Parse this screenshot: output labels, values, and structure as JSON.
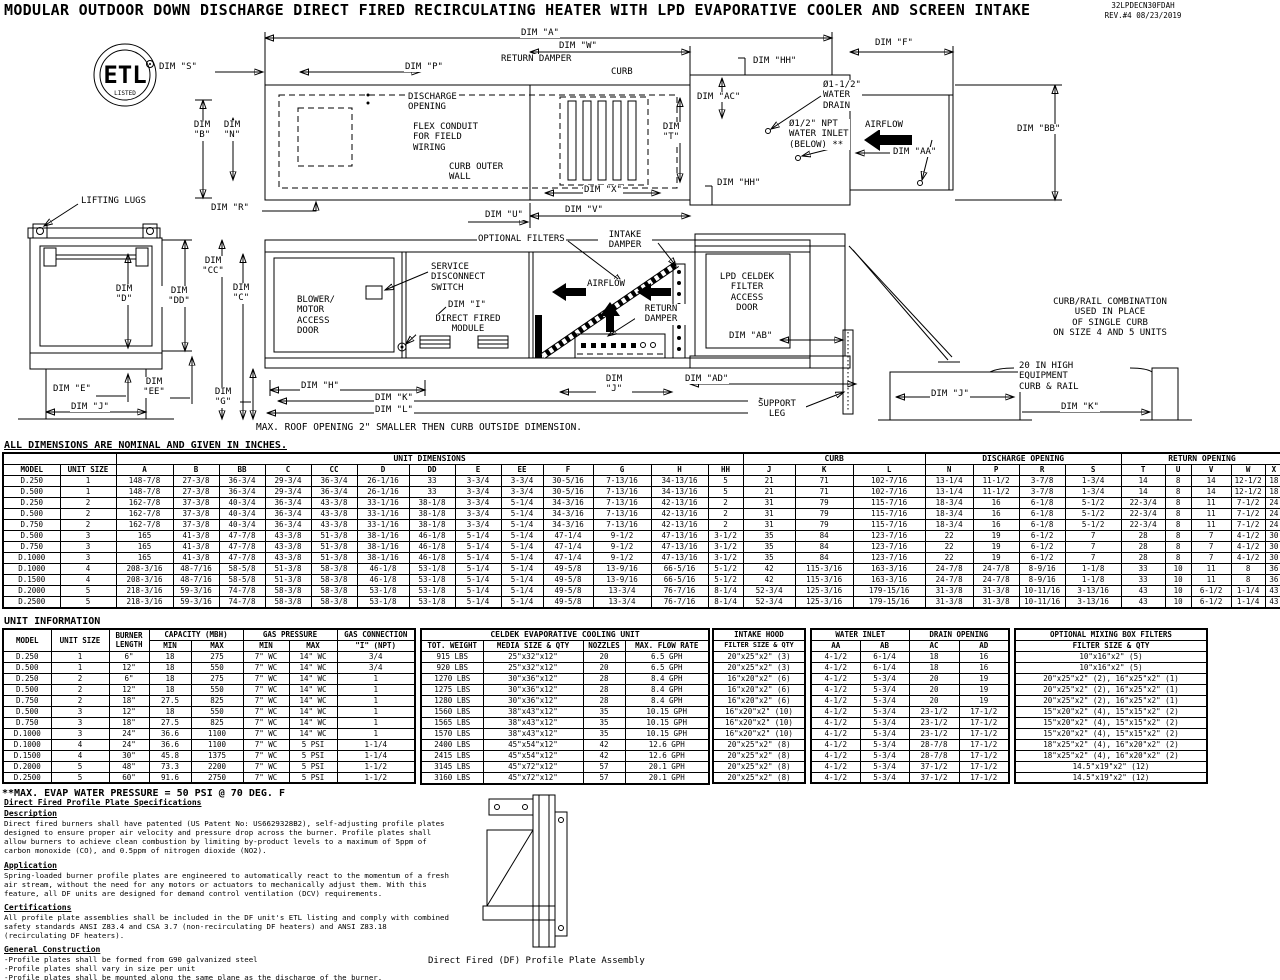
{
  "header": {
    "title": "MODULAR OUTDOOR DOWN DISCHARGE DIRECT FIRED RECIRCULATING HEATER WITH LPD EVAPORATIVE COOLER AND SCREEN INTAKE",
    "doc_number": "32LPDECN30FDAH",
    "rev": "REV.#4   08/23/2019"
  },
  "drawing": {
    "labels": {
      "etl_mark": "ETL",
      "etl_listed": "LISTED",
      "dim_a": "DIM \"A\"",
      "dim_w": "DIM \"W\"",
      "dim_f": "DIM \"F\"",
      "dim_hh_top": "DIM \"HH\"",
      "dim_hh_bottom": "DIM \"HH\"",
      "dim_s": "DIM \"S\"",
      "dim_p": "DIM \"P\"",
      "return_damper_plan": "RETURN DAMPER",
      "curb": "CURB",
      "dim_b": "DIM\n\"B\"",
      "dim_n": "DIM\n\"N\"",
      "dim_r": "DIM \"R\"",
      "discharge_opening": "DISCHARGE\nOPENING",
      "flex_conduit": "FLEX CONDUIT\nFOR FIELD\nWIRING",
      "curb_outer_wall": "CURB OUTER\nWALL",
      "dim_ac": "DIM \"AC\"",
      "water_drain": "Ø1-1/2\"\nWATER\nDRAIN",
      "water_inlet": "Ø1/2\" NPT\nWATER INLET\n(BELOW) **",
      "airflow_plan": "AIRFLOW",
      "dim_aa": "DIM \"AA\"",
      "dim_bb": "DIM \"BB\"",
      "dim_t": "DIM\n\"T\"",
      "dim_x": "DIM \"X\"",
      "dim_u": "DIM \"U\"",
      "dim_v": "DIM \"V\"",
      "lifting_lugs": "LIFTING LUGS",
      "dim_d": "DIM\n\"D\"",
      "dim_dd": "DIM\n\"DD\"",
      "dim_cc": "DIM\n\"CC\"",
      "dim_c": "DIM\n\"C\"",
      "dim_e": "DIM \"E\"",
      "dim_ee": "DIM\n\"EE\"",
      "dim_j_end": "DIM \"J\"",
      "dim_g": "DIM\n\"G\"",
      "blower_door": "BLOWER/\nMOTOR\nACCESS\nDOOR",
      "service_switch": "SERVICE\nDISCONNECT\nSWITCH",
      "dim_i": "DIM \"I\"",
      "direct_fired_module": "DIRECT FIRED\nMODULE",
      "optional_filters": "OPTIONAL FILTERS",
      "intake_damper": "INTAKE\nDAMPER",
      "airflow_elev": "AIRFLOW",
      "return_damper_elev": "RETURN\nDAMPER",
      "lpd_door": "LPD CELDEK\nFILTER\nACCESS\nDOOR",
      "dim_ab": "DIM \"AB\"",
      "dim_ad": "DIM \"AD\"",
      "support_leg": "SUPPORT\nLEG",
      "dim_h": "DIM \"H\"",
      "dim_k_main": "DIM \"K\"",
      "dim_l": "DIM \"L\"",
      "dim_j_mid": "DIM\n\"J\"",
      "curb_rail_note": "CURB/RAIL COMBINATION\nUSED IN PLACE\nOF SINGLE CURB\nON SIZE 4 AND 5 UNITS",
      "equip_curb": "20 IN HIGH\nEQUIPMENT\nCURB & RAIL",
      "dim_j_curb": "DIM \"J\"",
      "dim_k_curb": "DIM \"K\""
    }
  },
  "notes": {
    "roof": "MAX. ROOF OPENING 2\" SMALLER THEN CURB OUTSIDE DIMENSION.",
    "dims": "ALL DIMENSIONS ARE NOMINAL AND GIVEN IN INCHES.",
    "unit_info_title": "UNIT INFORMATION",
    "evap": "**MAX. EVAP WATER PRESSURE = 50 PSI @ 70 DEG. F"
  },
  "dim_table": {
    "groups": {
      "unit_dimensions": "UNIT DIMENSIONS",
      "curb": "CURB",
      "discharge_opening": "DISCHARGE OPENING",
      "return_opening": "RETURN OPENING"
    },
    "col_headers": [
      "MODEL",
      "UNIT SIZE",
      "A",
      "B",
      "BB",
      "C",
      "CC",
      "D",
      "DD",
      "E",
      "EE",
      "F",
      "G",
      "H",
      "HH",
      "J",
      "K",
      "L",
      "N",
      "P",
      "R",
      "S",
      "T",
      "U",
      "V",
      "W",
      "X"
    ],
    "rows": [
      [
        "D.250",
        "1",
        "148-7/8",
        "27-3/8",
        "36-3/4",
        "29-3/4",
        "36-3/4",
        "26-1/16",
        "33",
        "3-3/4",
        "3-3/4",
        "30-5/16",
        "7-13/16",
        "34-13/16",
        "5",
        "21",
        "71",
        "102-7/16",
        "13-1/4",
        "11-1/2",
        "3-7/8",
        "1-3/4",
        "14",
        "8",
        "14",
        "12-1/2",
        "18"
      ],
      [
        "D.500",
        "1",
        "148-7/8",
        "27-3/8",
        "36-3/4",
        "29-3/4",
        "36-3/4",
        "26-1/16",
        "33",
        "3-3/4",
        "3-3/4",
        "30-5/16",
        "7-13/16",
        "34-13/16",
        "5",
        "21",
        "71",
        "102-7/16",
        "13-1/4",
        "11-1/2",
        "3-7/8",
        "1-3/4",
        "14",
        "8",
        "14",
        "12-1/2",
        "18"
      ],
      [
        "D.250",
        "2",
        "162-7/8",
        "37-3/8",
        "40-3/4",
        "36-3/4",
        "43-3/8",
        "33-1/16",
        "38-1/8",
        "3-3/4",
        "5-1/4",
        "34-3/16",
        "7-13/16",
        "42-13/16",
        "2",
        "31",
        "79",
        "115-7/16",
        "18-3/4",
        "16",
        "6-1/8",
        "5-1/2",
        "22-3/4",
        "8",
        "11",
        "7-1/2",
        "24"
      ],
      [
        "D.500",
        "2",
        "162-7/8",
        "37-3/8",
        "40-3/4",
        "36-3/4",
        "43-3/8",
        "33-1/16",
        "38-1/8",
        "3-3/4",
        "5-1/4",
        "34-3/16",
        "7-13/16",
        "42-13/16",
        "2",
        "31",
        "79",
        "115-7/16",
        "18-3/4",
        "16",
        "6-1/8",
        "5-1/2",
        "22-3/4",
        "8",
        "11",
        "7-1/2",
        "24"
      ],
      [
        "D.750",
        "2",
        "162-7/8",
        "37-3/8",
        "40-3/4",
        "36-3/4",
        "43-3/8",
        "33-1/16",
        "38-1/8",
        "3-3/4",
        "5-1/4",
        "34-3/16",
        "7-13/16",
        "42-13/16",
        "2",
        "31",
        "79",
        "115-7/16",
        "18-3/4",
        "16",
        "6-1/8",
        "5-1/2",
        "22-3/4",
        "8",
        "11",
        "7-1/2",
        "24"
      ],
      [
        "D.500",
        "3",
        "165",
        "41-3/8",
        "47-7/8",
        "43-3/8",
        "51-3/8",
        "38-1/16",
        "46-1/8",
        "5-1/4",
        "5-1/4",
        "47-1/4",
        "9-1/2",
        "47-13/16",
        "3-1/2",
        "35",
        "84",
        "123-7/16",
        "22",
        "19",
        "6-1/2",
        "7",
        "28",
        "8",
        "7",
        "4-1/2",
        "30"
      ],
      [
        "D.750",
        "3",
        "165",
        "41-3/8",
        "47-7/8",
        "43-3/8",
        "51-3/8",
        "38-1/16",
        "46-1/8",
        "5-1/4",
        "5-1/4",
        "47-1/4",
        "9-1/2",
        "47-13/16",
        "3-1/2",
        "35",
        "84",
        "123-7/16",
        "22",
        "19",
        "6-1/2",
        "7",
        "28",
        "8",
        "7",
        "4-1/2",
        "30"
      ],
      [
        "D.1000",
        "3",
        "165",
        "41-3/8",
        "47-7/8",
        "43-3/8",
        "51-3/8",
        "38-1/16",
        "46-1/8",
        "5-1/4",
        "5-1/4",
        "47-1/4",
        "9-1/2",
        "47-13/16",
        "3-1/2",
        "35",
        "84",
        "123-7/16",
        "22",
        "19",
        "6-1/2",
        "7",
        "28",
        "8",
        "7",
        "4-1/2",
        "30"
      ],
      [
        "D.1000",
        "4",
        "208-3/16",
        "48-7/16",
        "58-5/8",
        "51-3/8",
        "58-3/8",
        "46-1/8",
        "53-1/8",
        "5-1/4",
        "5-1/4",
        "49-5/8",
        "13-9/16",
        "66-5/16",
        "5-1/2",
        "42",
        "115-3/16",
        "163-3/16",
        "24-7/8",
        "24-7/8",
        "8-9/16",
        "1-1/8",
        "33",
        "10",
        "11",
        "8",
        "36"
      ],
      [
        "D.1500",
        "4",
        "208-3/16",
        "48-7/16",
        "58-5/8",
        "51-3/8",
        "58-3/8",
        "46-1/8",
        "53-1/8",
        "5-1/4",
        "5-1/4",
        "49-5/8",
        "13-9/16",
        "66-5/16",
        "5-1/2",
        "42",
        "115-3/16",
        "163-3/16",
        "24-7/8",
        "24-7/8",
        "8-9/16",
        "1-1/8",
        "33",
        "10",
        "11",
        "8",
        "36"
      ],
      [
        "D.2000",
        "5",
        "218-3/16",
        "59-3/16",
        "74-7/8",
        "58-3/8",
        "58-3/8",
        "53-1/8",
        "53-1/8",
        "5-1/4",
        "5-1/4",
        "49-5/8",
        "13-3/4",
        "76-7/16",
        "8-1/4",
        "52-3/4",
        "125-3/16",
        "179-15/16",
        "31-3/8",
        "31-3/8",
        "10-11/16",
        "3-13/16",
        "43",
        "10",
        "6-1/2",
        "1-1/4",
        "43"
      ],
      [
        "D.2500",
        "5",
        "218-3/16",
        "59-3/16",
        "74-7/8",
        "58-3/8",
        "58-3/8",
        "53-1/8",
        "53-1/8",
        "5-1/4",
        "5-1/4",
        "49-5/8",
        "13-3/4",
        "76-7/16",
        "8-1/4",
        "52-3/4",
        "125-3/16",
        "179-15/16",
        "31-3/8",
        "31-3/8",
        "10-11/16",
        "3-13/16",
        "43",
        "10",
        "6-1/2",
        "1-1/4",
        "43"
      ]
    ]
  },
  "unit_info": {
    "headers": {
      "model": "MODEL",
      "unit_size": "UNIT SIZE",
      "burner_length": "BURNER LENGTH",
      "capacity": "CAPACITY (MBH)",
      "min": "MIN",
      "max": "MAX",
      "gas_pressure": "GAS PRESSURE",
      "gas_connection": "GAS CONNECTION",
      "npt": "\"I\" (NPT)"
    },
    "rows": [
      [
        "D.250",
        "1",
        "6\"",
        "18",
        "275",
        "7\" WC",
        "14\" WC",
        "3/4"
      ],
      [
        "D.500",
        "1",
        "12\"",
        "18",
        "550",
        "7\" WC",
        "14\" WC",
        "3/4"
      ],
      [
        "D.250",
        "2",
        "6\"",
        "18",
        "275",
        "7\" WC",
        "14\" WC",
        "1"
      ],
      [
        "D.500",
        "2",
        "12\"",
        "18",
        "550",
        "7\" WC",
        "14\" WC",
        "1"
      ],
      [
        "D.750",
        "2",
        "18\"",
        "27.5",
        "825",
        "7\" WC",
        "14\" WC",
        "1"
      ],
      [
        "D.500",
        "3",
        "12\"",
        "18",
        "550",
        "7\" WC",
        "14\" WC",
        "1"
      ],
      [
        "D.750",
        "3",
        "18\"",
        "27.5",
        "825",
        "7\" WC",
        "14\" WC",
        "1"
      ],
      [
        "D.1000",
        "3",
        "24\"",
        "36.6",
        "1100",
        "7\" WC",
        "14\" WC",
        "1"
      ],
      [
        "D.1000",
        "4",
        "24\"",
        "36.6",
        "1100",
        "7\" WC",
        "5 PSI",
        "1-1/4"
      ],
      [
        "D.1500",
        "4",
        "30\"",
        "45.8",
        "1375",
        "7\" WC",
        "5 PSI",
        "1-1/4"
      ],
      [
        "D.2000",
        "5",
        "48\"",
        "73.3",
        "2200",
        "7\" WC",
        "5 PSI",
        "1-1/2"
      ],
      [
        "D.2500",
        "5",
        "60\"",
        "91.6",
        "2750",
        "7\" WC",
        "5 PSI",
        "1-1/2"
      ]
    ]
  },
  "celdek": {
    "title": "CELDEK EVAPORATIVE COOLING UNIT",
    "col_headers": [
      "TOT. WEIGHT",
      "MEDIA SIZE & QTY",
      "NOZZLES",
      "MAX. FLOW RATE"
    ],
    "rows": [
      [
        "915 LBS",
        "25\"x32\"x12\"",
        "20",
        "6.5 GPH"
      ],
      [
        "920 LBS",
        "25\"x32\"x12\"",
        "20",
        "6.5 GPH"
      ],
      [
        "1270 LBS",
        "30\"x36\"x12\"",
        "28",
        "8.4 GPH"
      ],
      [
        "1275 LBS",
        "30\"x36\"x12\"",
        "28",
        "8.4 GPH"
      ],
      [
        "1280 LBS",
        "30\"x36\"x12\"",
        "28",
        "8.4 GPH"
      ],
      [
        "1560 LBS",
        "38\"x43\"x12\"",
        "35",
        "10.15 GPH"
      ],
      [
        "1565 LBS",
        "38\"x43\"x12\"",
        "35",
        "10.15 GPH"
      ],
      [
        "1570 LBS",
        "38\"x43\"x12\"",
        "35",
        "10.15 GPH"
      ],
      [
        "2400 LBS",
        "45\"x54\"x12\"",
        "42",
        "12.6 GPH"
      ],
      [
        "2415 LBS",
        "45\"x54\"x12\"",
        "42",
        "12.6 GPH"
      ],
      [
        "3145 LBS",
        "45\"x72\"x12\"",
        "57",
        "20.1 GPH"
      ],
      [
        "3160 LBS",
        "45\"x72\"x12\"",
        "57",
        "20.1 GPH"
      ]
    ]
  },
  "intake_hood": {
    "title": "INTAKE HOOD",
    "subtitle": "FILTER SIZE & QTY",
    "rows": [
      "20\"x25\"x2\" (3)",
      "20\"x25\"x2\" (3)",
      "16\"x20\"x2\" (6)",
      "16\"x20\"x2\" (6)",
      "16\"x20\"x2\" (6)",
      "16\"x20\"x2\" (10)",
      "16\"x20\"x2\" (10)",
      "16\"x20\"x2\" (10)",
      "20\"x25\"x2\" (8)",
      "20\"x25\"x2\" (8)",
      "20\"x25\"x2\" (8)",
      "20\"x25\"x2\" (8)"
    ]
  },
  "water_drain_table": {
    "water_inlet": "WATER INLET",
    "drain_opening": "DRAIN OPENING",
    "col_headers": [
      "AA",
      "AB",
      "AC",
      "AD"
    ],
    "rows": [
      [
        "4-1/2",
        "6-1/4",
        "18",
        "16"
      ],
      [
        "4-1/2",
        "6-1/4",
        "18",
        "16"
      ],
      [
        "4-1/2",
        "5-3/4",
        "20",
        "19"
      ],
      [
        "4-1/2",
        "5-3/4",
        "20",
        "19"
      ],
      [
        "4-1/2",
        "5-3/4",
        "20",
        "19"
      ],
      [
        "4-1/2",
        "5-3/4",
        "23-1/2",
        "17-1/2"
      ],
      [
        "4-1/2",
        "5-3/4",
        "23-1/2",
        "17-1/2"
      ],
      [
        "4-1/2",
        "5-3/4",
        "23-1/2",
        "17-1/2"
      ],
      [
        "4-1/2",
        "5-3/4",
        "28-7/8",
        "17-1/2"
      ],
      [
        "4-1/2",
        "5-3/4",
        "28-7/8",
        "17-1/2"
      ],
      [
        "4-1/2",
        "5-3/4",
        "37-1/2",
        "17-1/2"
      ],
      [
        "4-1/2",
        "5-3/4",
        "37-1/2",
        "17-1/2"
      ]
    ]
  },
  "mixing_box": {
    "title": "OPTIONAL MIXING BOX FILTERS",
    "subtitle": "FILTER SIZE & QTY",
    "rows": [
      "10\"x16\"x2\" (5)",
      "10\"x16\"x2\" (5)",
      "20\"x25\"x2\" (2), 16\"x25\"x2\" (1)",
      "20\"x25\"x2\" (2), 16\"x25\"x2\" (1)",
      "20\"x25\"x2\" (2), 16\"x25\"x2\" (1)",
      "15\"x20\"x2\" (4), 15\"x15\"x2\" (2)",
      "15\"x20\"x2\" (4), 15\"x15\"x2\" (2)",
      "15\"x20\"x2\" (4), 15\"x15\"x2\" (2)",
      "18\"x25\"x2\" (4), 16\"x20\"x2\" (2)",
      "18\"x25\"x2\" (4), 16\"x20\"x2\" (2)",
      "14.5\"x19\"x2\" (12)",
      "14.5\"x19\"x2\" (12)"
    ]
  },
  "specs": {
    "heading": "Direct Fired Profile Plate Specifications",
    "sections": [
      {
        "heading": "Description",
        "body": "Direct fired burners shall have patented (US Patent No: US6629328B2), self-adjusting profile plates designed to ensure proper air velocity and pressure drop across the burner. Profile plates shall allow burners to achieve clean combustion by limiting by-product levels to a maximum of 5ppm of carbon monoxide (CO), and 0.5ppm of nitrogen dioxide (NO2)."
      },
      {
        "heading": "Application",
        "body": "Spring-loaded burner profile plates are engineered to automatically react to the momentum of a fresh air stream, without the need for any motors or actuators to mechanically adjust them. With this feature, all DF units are designed for demand control ventilation (DCV) requirements."
      },
      {
        "heading": "Certifications",
        "body": "All profile plate assemblies shall be included in the DF unit's ETL listing and comply with combined safety standards ANSI Z83.4 and CSA 3.7 (non-recirculating DF heaters) and ANSI Z83.18 (recirculating DF heaters)."
      },
      {
        "heading": "General Construction",
        "body": "-Profile plates shall be formed from G90 galvanized steel\n-Profile plates shall vary in size per unit\n-Profile plates shall be mounted along the same plane as the discharge of the burner.\n-Design shall incorporate properly torqued, permanently mounted spring hinges.\n-Spring hinges shall be made from plated steel"
      }
    ]
  },
  "caption": "Direct Fired (DF) Profile Plate Assembly"
}
